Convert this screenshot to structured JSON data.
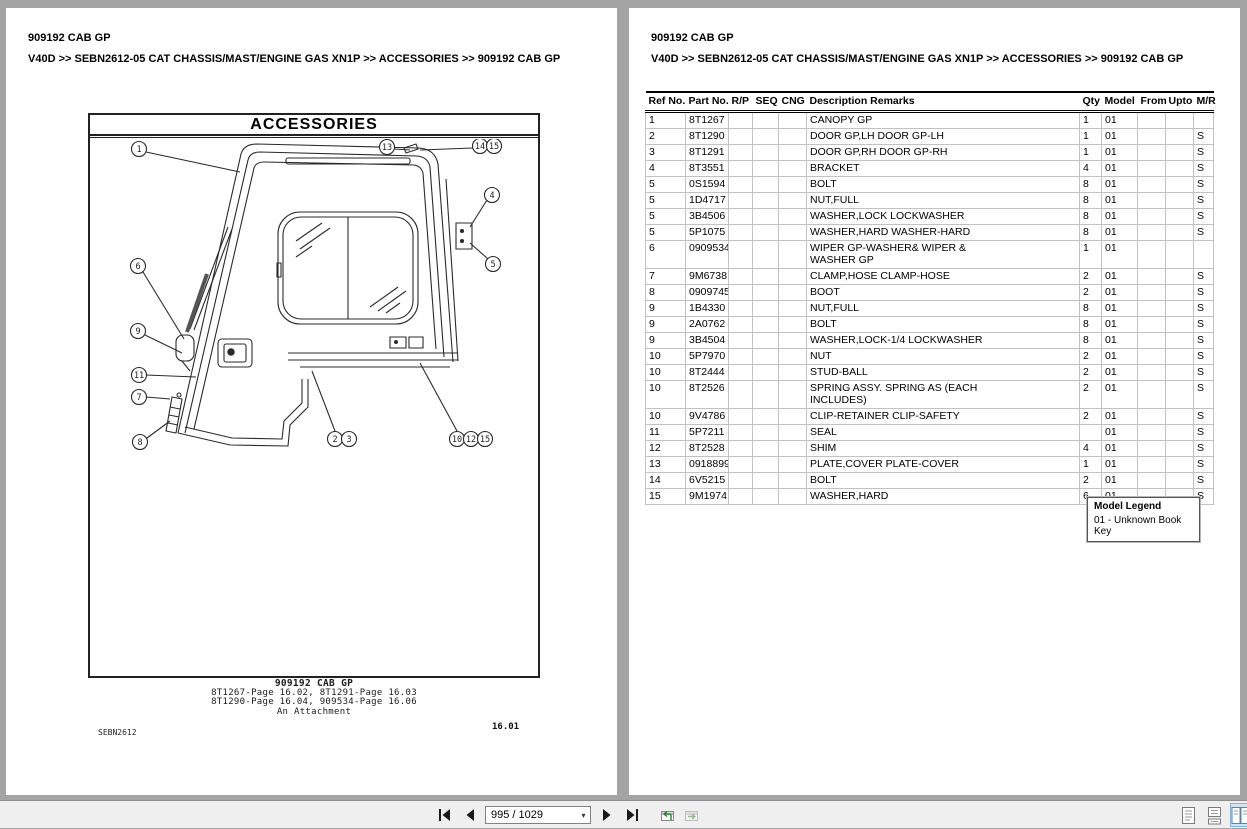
{
  "page_left": {
    "title": "909192 CAB GP",
    "breadcrumb": "V40D >> SEBN2612-05 CAT CHASSIS/MAST/ENGINE GAS XN1P >> ACCESSORIES >> 909192 CAB GP",
    "diagram": {
      "title": "ACCESSORIES",
      "callouts": {
        "c1": "1",
        "c2": "2",
        "c3": "3",
        "c4": "4",
        "c5": "5",
        "c6": "6",
        "c7": "7",
        "c8": "8",
        "c9": "9",
        "c10": "10",
        "c11": "11",
        "c12": "12",
        "c13": "13",
        "c14": "14",
        "c15a": "15",
        "c15b": "15"
      },
      "caption_title": "909192 CAB GP",
      "caption_line1": "8T1267-Page 16.02, 8T1291-Page 16.03",
      "caption_line2": "8T1290-Page 16.04, 909534-Page 16.06",
      "caption_line3": "An Attachment",
      "doc_code": "SEBN2612",
      "page_code": "16.01"
    }
  },
  "page_right": {
    "title": "909192 CAB GP",
    "breadcrumb": "V40D >> SEBN2612-05 CAT CHASSIS/MAST/ENGINE GAS XN1P >> ACCESSORIES >> 909192 CAB GP",
    "table": {
      "headers": [
        "Ref No.",
        "Part No.",
        "R/P",
        "SEQ",
        "CNG",
        "Description Remarks",
        "Qty",
        "Model",
        "From",
        "Upto",
        "M/R"
      ],
      "rows": [
        [
          "1",
          "8T1267",
          "",
          "",
          "",
          "CANOPY GP",
          "1",
          "01",
          "",
          "",
          ""
        ],
        [
          "2",
          "8T1290",
          "",
          "",
          "",
          "DOOR GP,LH DOOR GP-LH",
          "1",
          "01",
          "",
          "",
          "S"
        ],
        [
          "3",
          "8T1291",
          "",
          "",
          "",
          "DOOR GP,RH DOOR GP-RH",
          "1",
          "01",
          "",
          "",
          "S"
        ],
        [
          "4",
          "8T3551",
          "",
          "",
          "",
          "BRACKET",
          "4",
          "01",
          "",
          "",
          "S"
        ],
        [
          "5",
          "0S1594",
          "",
          "",
          "",
          "BOLT",
          "8",
          "01",
          "",
          "",
          "S"
        ],
        [
          "5",
          "1D4717",
          "",
          "",
          "",
          "NUT,FULL",
          "8",
          "01",
          "",
          "",
          "S"
        ],
        [
          "5",
          "3B4506",
          "",
          "",
          "",
          "WASHER,LOCK LOCKWASHER",
          "8",
          "01",
          "",
          "",
          "S"
        ],
        [
          "5",
          "5P1075",
          "",
          "",
          "",
          "WASHER,HARD WASHER-HARD",
          "8",
          "01",
          "",
          "",
          "S"
        ],
        [
          "6",
          "0909534",
          "",
          "",
          "",
          "WIPER GP-WASHER& WIPER &\nWASHER GP",
          "1",
          "01",
          "",
          "",
          ""
        ],
        [
          "7",
          "9M6738",
          "",
          "",
          "",
          "CLAMP,HOSE CLAMP-HOSE",
          "2",
          "01",
          "",
          "",
          "S"
        ],
        [
          "8",
          "0909745",
          "",
          "",
          "",
          "BOOT",
          "2",
          "01",
          "",
          "",
          "S"
        ],
        [
          "9",
          "1B4330",
          "",
          "",
          "",
          "NUT,FULL",
          "8",
          "01",
          "",
          "",
          "S"
        ],
        [
          "9",
          "2A0762",
          "",
          "",
          "",
          "BOLT",
          "8",
          "01",
          "",
          "",
          "S"
        ],
        [
          "9",
          "3B4504",
          "",
          "",
          "",
          "WASHER,LOCK-1/4 LOCKWASHER",
          "8",
          "01",
          "",
          "",
          "S"
        ],
        [
          "10",
          "5P7970",
          "",
          "",
          "",
          "NUT",
          "2",
          "01",
          "",
          "",
          "S"
        ],
        [
          "10",
          "8T2444",
          "",
          "",
          "",
          "STUD-BALL",
          "2",
          "01",
          "",
          "",
          "S"
        ],
        [
          "10",
          "8T2526",
          "",
          "",
          "",
          "SPRING ASSY. SPRING AS (EACH\nINCLUDES)",
          "2",
          "01",
          "",
          "",
          "S"
        ],
        [
          "10",
          "9V4786",
          "",
          "",
          "",
          "CLIP-RETAINER CLIP-SAFETY",
          "2",
          "01",
          "",
          "",
          "S"
        ],
        [
          "11",
          "5P7211",
          "",
          "",
          "",
          "SEAL",
          "",
          "01",
          "",
          "",
          "S"
        ],
        [
          "12",
          "8T2528",
          "",
          "",
          "",
          "SHIM",
          "4",
          "01",
          "",
          "",
          "S"
        ],
        [
          "13",
          "0918899",
          "",
          "",
          "",
          "PLATE,COVER PLATE-COVER",
          "1",
          "01",
          "",
          "",
          "S"
        ],
        [
          "14",
          "6V5215",
          "",
          "",
          "",
          "BOLT",
          "2",
          "01",
          "",
          "",
          "S"
        ],
        [
          "15",
          "9M1974",
          "",
          "",
          "",
          "WASHER,HARD",
          "6",
          "01",
          "",
          "",
          "S"
        ]
      ]
    },
    "model_legend": {
      "title": "Model Legend",
      "entry": "01 - Unknown Book Key"
    }
  },
  "statusbar": {
    "page_indicator": "995 / 1029",
    "icons": [
      "first-page",
      "previous-page",
      "next-page",
      "last-page",
      "previous-view",
      "next-view",
      "single-page-layout",
      "continuous-layout",
      "facing-layout"
    ]
  },
  "colors": {
    "viewer_bg": "#a4a4a4",
    "toolbar_bg": "#efefef",
    "selected_layout_bg": "#cfe3f6",
    "selected_layout_border": "#86aed6",
    "view_arrow_green": "#2e7d32",
    "drawing_ink": "#2a2a2a"
  }
}
